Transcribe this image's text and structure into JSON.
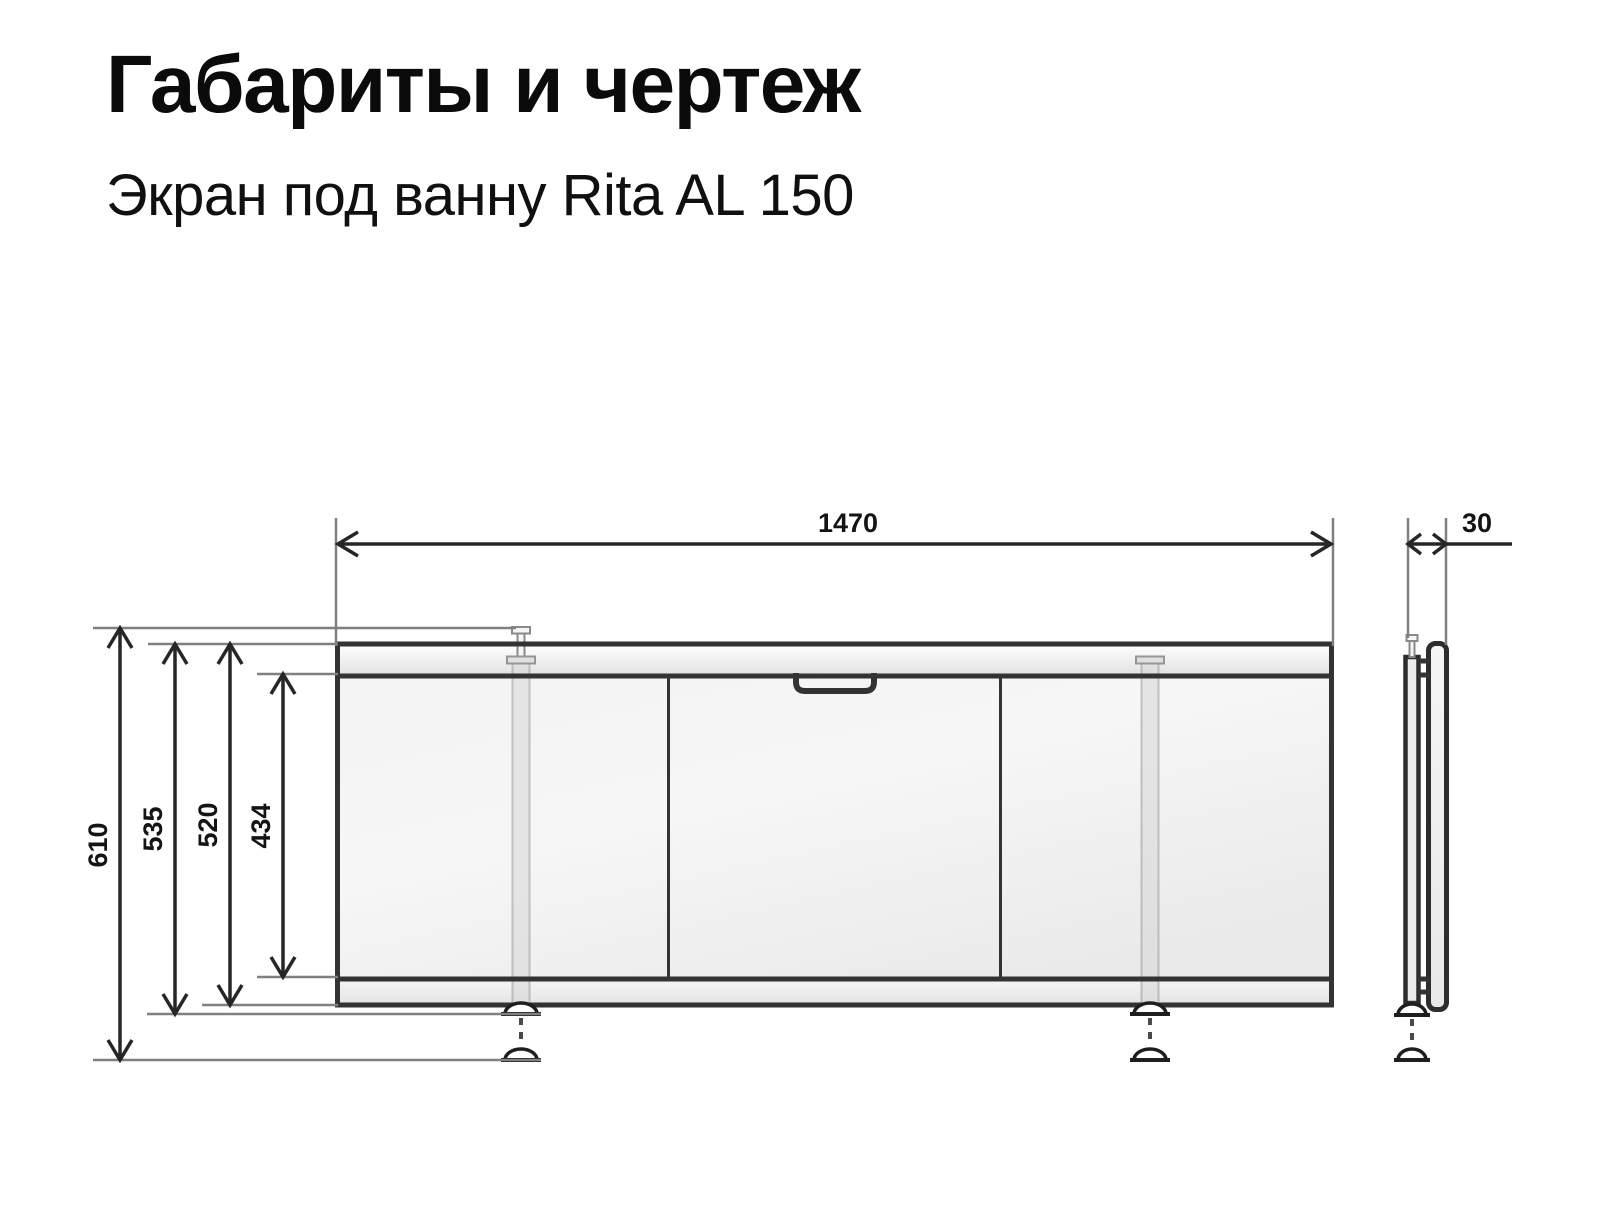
{
  "page": {
    "title": "Габариты и чертеж",
    "subtitle": "Экран под ванну Rita AL 150"
  },
  "drawing": {
    "dimensions": {
      "width": "1470",
      "overall_height": "610",
      "height_feet_retracted": "535",
      "screen_height": "520",
      "panel_height": "434",
      "depth": "30"
    },
    "colors": {
      "outline": "#333333",
      "dimension_line": "#262626",
      "extension_line": "#808080",
      "panel_fill": "#f0f0f0",
      "background": "#ffffff"
    }
  }
}
